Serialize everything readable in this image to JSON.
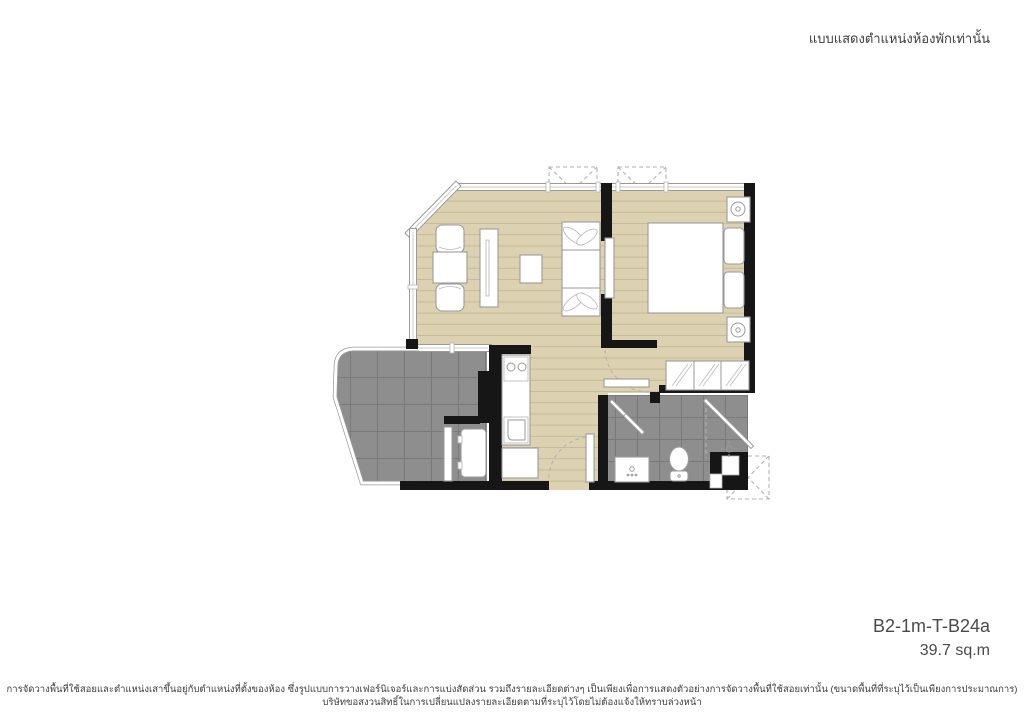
{
  "header": {
    "note": "แบบแสดงตำแหน่งห้องพักเท่านั้น"
  },
  "unit": {
    "code": "B2-1m-T-B24a",
    "area": "39.7 sq.m"
  },
  "footer": {
    "line1": "การจัดวางพื้นที่ใช้สอยและตำแหน่งเสาขึ้นอยู่กับตำแหน่งที่ตั้งของห้อง ซึ่งรูปแบบการวางเฟอร์นิเจอร์และการแบ่งสัดส่วน รวมถึงรายละเอียดต่างๆ เป็นเพียงเพื่อการแสดงตัวอย่างการจัดวางพื้นที่ใช้สอยเท่านั้น (ขนาดพื้นที่ที่ระบุไว้เป็นเพียงการประมาณการ)",
    "line2": "บริษัทขอสงวนสิทธิ์ในการเปลี่ยนแปลงรายละเอียดตามที่ระบุไว้โดยไม่ต้องแจ้งให้ทราบล่วงหน้า"
  },
  "palette": {
    "floor_wood": "#dcd2b1",
    "floor_wood_line": "#c6ba97",
    "tile_gray": "#8e8e8e",
    "tile_line": "#7a7a7a",
    "wall": "#161616",
    "dash": "#b2b2b2"
  }
}
